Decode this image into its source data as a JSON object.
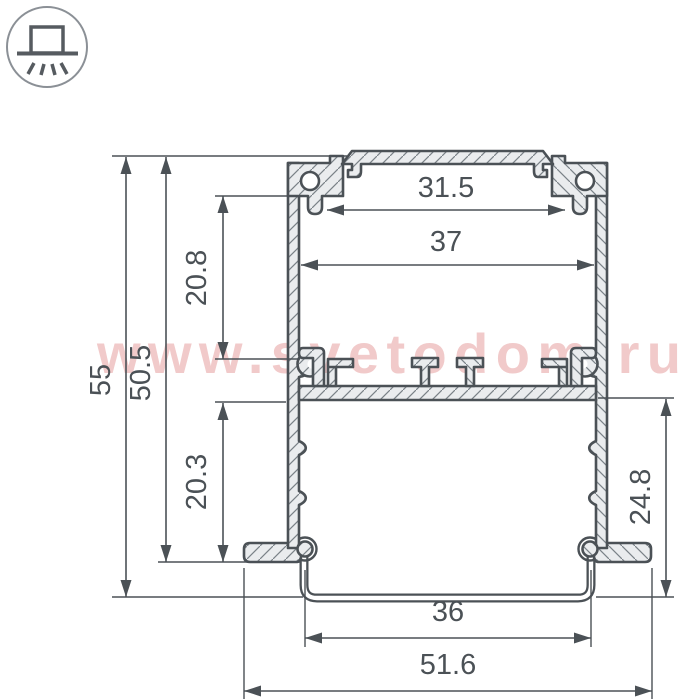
{
  "icon": {
    "name": "recessed-downlight-icon",
    "description": "surface box on line with downward light rays"
  },
  "watermark": {
    "text": "www.svetodom.ru",
    "color": "#f1caca"
  },
  "colors": {
    "line": "#4b5156",
    "profile_fill": "#eaecee",
    "hatch_line": "#7a8187",
    "icon_circle": "#8b9096",
    "icon_glyph": "#565b60",
    "dim_text": "#4b5156"
  },
  "drawing": {
    "type": "profile-cross-section-dimensioned",
    "dimensions": [
      {
        "id": "top-opening-width",
        "label": "31.5",
        "orient": "h",
        "x1": 327,
        "x2": 565,
        "y": 210,
        "lx": 446,
        "ly": 197
      },
      {
        "id": "inner-width",
        "label": "37",
        "orient": "h",
        "x1": 301,
        "x2": 594,
        "y": 265,
        "lx": 446,
        "ly": 251
      },
      {
        "id": "diffuser-width",
        "label": "36",
        "orient": "h",
        "x1": 305,
        "x2": 591,
        "y": 638,
        "lx": 448,
        "ly": 621
      },
      {
        "id": "overall-width",
        "label": "51.6",
        "orient": "h",
        "x1": 244,
        "x2": 652,
        "y": 691,
        "lx": 448,
        "ly": 674
      },
      {
        "id": "overall-height",
        "label": "55",
        "orient": "v",
        "x": 126,
        "y1": 157,
        "y2": 597,
        "lx": 110,
        "ly": 380
      },
      {
        "id": "body-height",
        "label": "50.5",
        "orient": "v",
        "x": 166,
        "y1": 157,
        "y2": 562,
        "lx": 150,
        "ly": 373
      },
      {
        "id": "upper-cavity-height",
        "label": "20.8",
        "orient": "v",
        "x": 223,
        "y1": 196,
        "y2": 359,
        "lx": 206,
        "ly": 278
      },
      {
        "id": "lower-cavity-height",
        "label": "20.3",
        "orient": "v",
        "x": 223,
        "y1": 403,
        "y2": 562,
        "lx": 206,
        "ly": 482
      },
      {
        "id": "recess-depth",
        "label": "24.8",
        "orient": "v",
        "x": 666,
        "y1": 399,
        "y2": 597,
        "lx": 650,
        "ly": 497
      }
    ],
    "ref_lines": [
      {
        "x1": 112,
        "y1": 156,
        "x2": 347,
        "y2": 156
      },
      {
        "x1": 112,
        "y1": 597,
        "x2": 303,
        "y2": 597
      },
      {
        "x1": 596,
        "y1": 597,
        "x2": 674,
        "y2": 597
      },
      {
        "x1": 158,
        "y1": 562,
        "x2": 300,
        "y2": 562
      },
      {
        "x1": 215,
        "y1": 196,
        "x2": 305,
        "y2": 196
      },
      {
        "x1": 215,
        "y1": 359,
        "x2": 300,
        "y2": 359
      },
      {
        "x1": 215,
        "y1": 402,
        "x2": 286,
        "y2": 402
      },
      {
        "x1": 598,
        "y1": 398,
        "x2": 674,
        "y2": 398
      },
      {
        "x1": 305,
        "y1": 570,
        "x2": 305,
        "y2": 647
      },
      {
        "x1": 591,
        "y1": 570,
        "x2": 591,
        "y2": 647
      },
      {
        "x1": 244,
        "y1": 568,
        "x2": 244,
        "y2": 699
      },
      {
        "x1": 652,
        "y1": 568,
        "x2": 652,
        "y2": 699
      }
    ],
    "dim_font_size": 29,
    "arrow": {
      "len": 17,
      "half_w": 5.5
    }
  }
}
